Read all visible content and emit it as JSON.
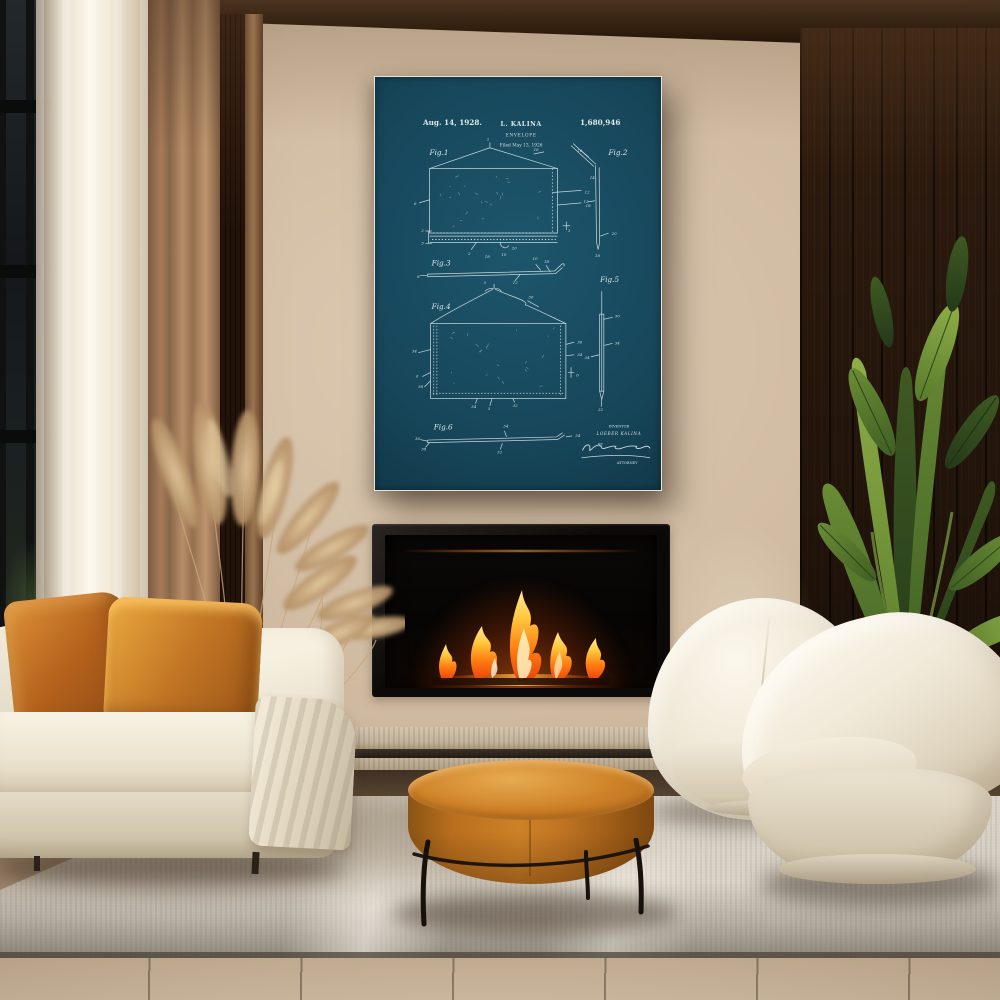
{
  "poster": {
    "date": "Aug. 14, 1928.",
    "inventor_short": "L. KALINA",
    "title": "ENVELOPE",
    "filed_line": "Filed May 13, 1926",
    "patent_number": "1,680,946",
    "inventor_block": {
      "label": "INVENTOR",
      "name": "LOEBER KALINA",
      "by": "BY",
      "attorney": "ATTORNEY"
    },
    "figures": [
      {
        "label": "Fig.1",
        "label_pos": [
          50,
          75
        ],
        "numerals": [
          [
            "2",
            105,
            61
          ],
          [
            "16",
            150,
            71
          ],
          [
            "12",
            199,
            112
          ],
          [
            "18",
            200,
            125
          ],
          [
            "6",
            35,
            123
          ],
          [
            "2",
            42,
            149
          ],
          [
            "3",
            42,
            161
          ],
          [
            "2",
            87,
            171
          ],
          [
            "18",
            103,
            174
          ],
          [
            "10",
            119,
            172
          ],
          [
            "20",
            129,
            166
          ],
          [
            "3",
            183,
            149
          ]
        ]
      },
      {
        "label": "Fig.2",
        "label_pos": [
          222,
          75
        ],
        "numerals": [
          [
            "16",
            192,
            72
          ],
          [
            "14",
            204,
            98
          ],
          [
            "12",
            198,
            121
          ],
          [
            "20",
            225,
            152
          ],
          [
            "18",
            209,
            173
          ]
        ]
      },
      {
        "label": "Fig.3",
        "label_pos": [
          52,
          181
        ],
        "numerals": [
          [
            "8",
            38,
            193
          ],
          [
            "10",
            149,
            176
          ],
          [
            "18",
            160,
            179
          ],
          [
            "12",
            130,
            199
          ]
        ]
      },
      {
        "label": "Fig.4",
        "label_pos": [
          52,
          223
        ],
        "numerals": [
          [
            "5",
            102,
            199
          ],
          [
            "30",
            145,
            213
          ],
          [
            "34",
            33,
            265
          ],
          [
            "6",
            37,
            289
          ],
          [
            "38",
            39,
            299
          ],
          [
            "36",
            192,
            256
          ],
          [
            "34",
            192,
            268
          ],
          [
            "6",
            191,
            288
          ],
          [
            "34",
            90,
            318
          ],
          [
            "5",
            106,
            320
          ],
          [
            "32",
            130,
            317
          ]
        ]
      },
      {
        "label": "Fig.5",
        "label_pos": [
          214,
          197
        ],
        "numerals": [
          [
            "30",
            228,
            231
          ],
          [
            "34",
            199,
            271
          ],
          [
            "34",
            228,
            257
          ],
          [
            "32",
            212,
            321
          ]
        ]
      },
      {
        "label": "Fig.6",
        "label_pos": [
          54,
          339
        ],
        "numerals": [
          [
            "36",
            36,
            349
          ],
          [
            "38",
            42,
            359
          ],
          [
            "34",
            121,
            337
          ],
          [
            "34",
            190,
            346
          ],
          [
            "32",
            115,
            362
          ]
        ]
      }
    ]
  },
  "colors": {
    "blueprint_bg": "#17465a",
    "blueprint_line": "#d6e4e6",
    "poster_frame": "#f4f2ec",
    "wall_beige": "#cdb89e",
    "dark_wood": "#271409",
    "amber_leather": "#c07a24",
    "pillow_amber": "#b4621c",
    "sofa_cream": "#ece5d4",
    "flame_orange": "#ff8c1a",
    "plant_green": "#4c6b2a",
    "pampas_tan": "#c9a87d",
    "rug_grey": "#d7d1c6"
  }
}
